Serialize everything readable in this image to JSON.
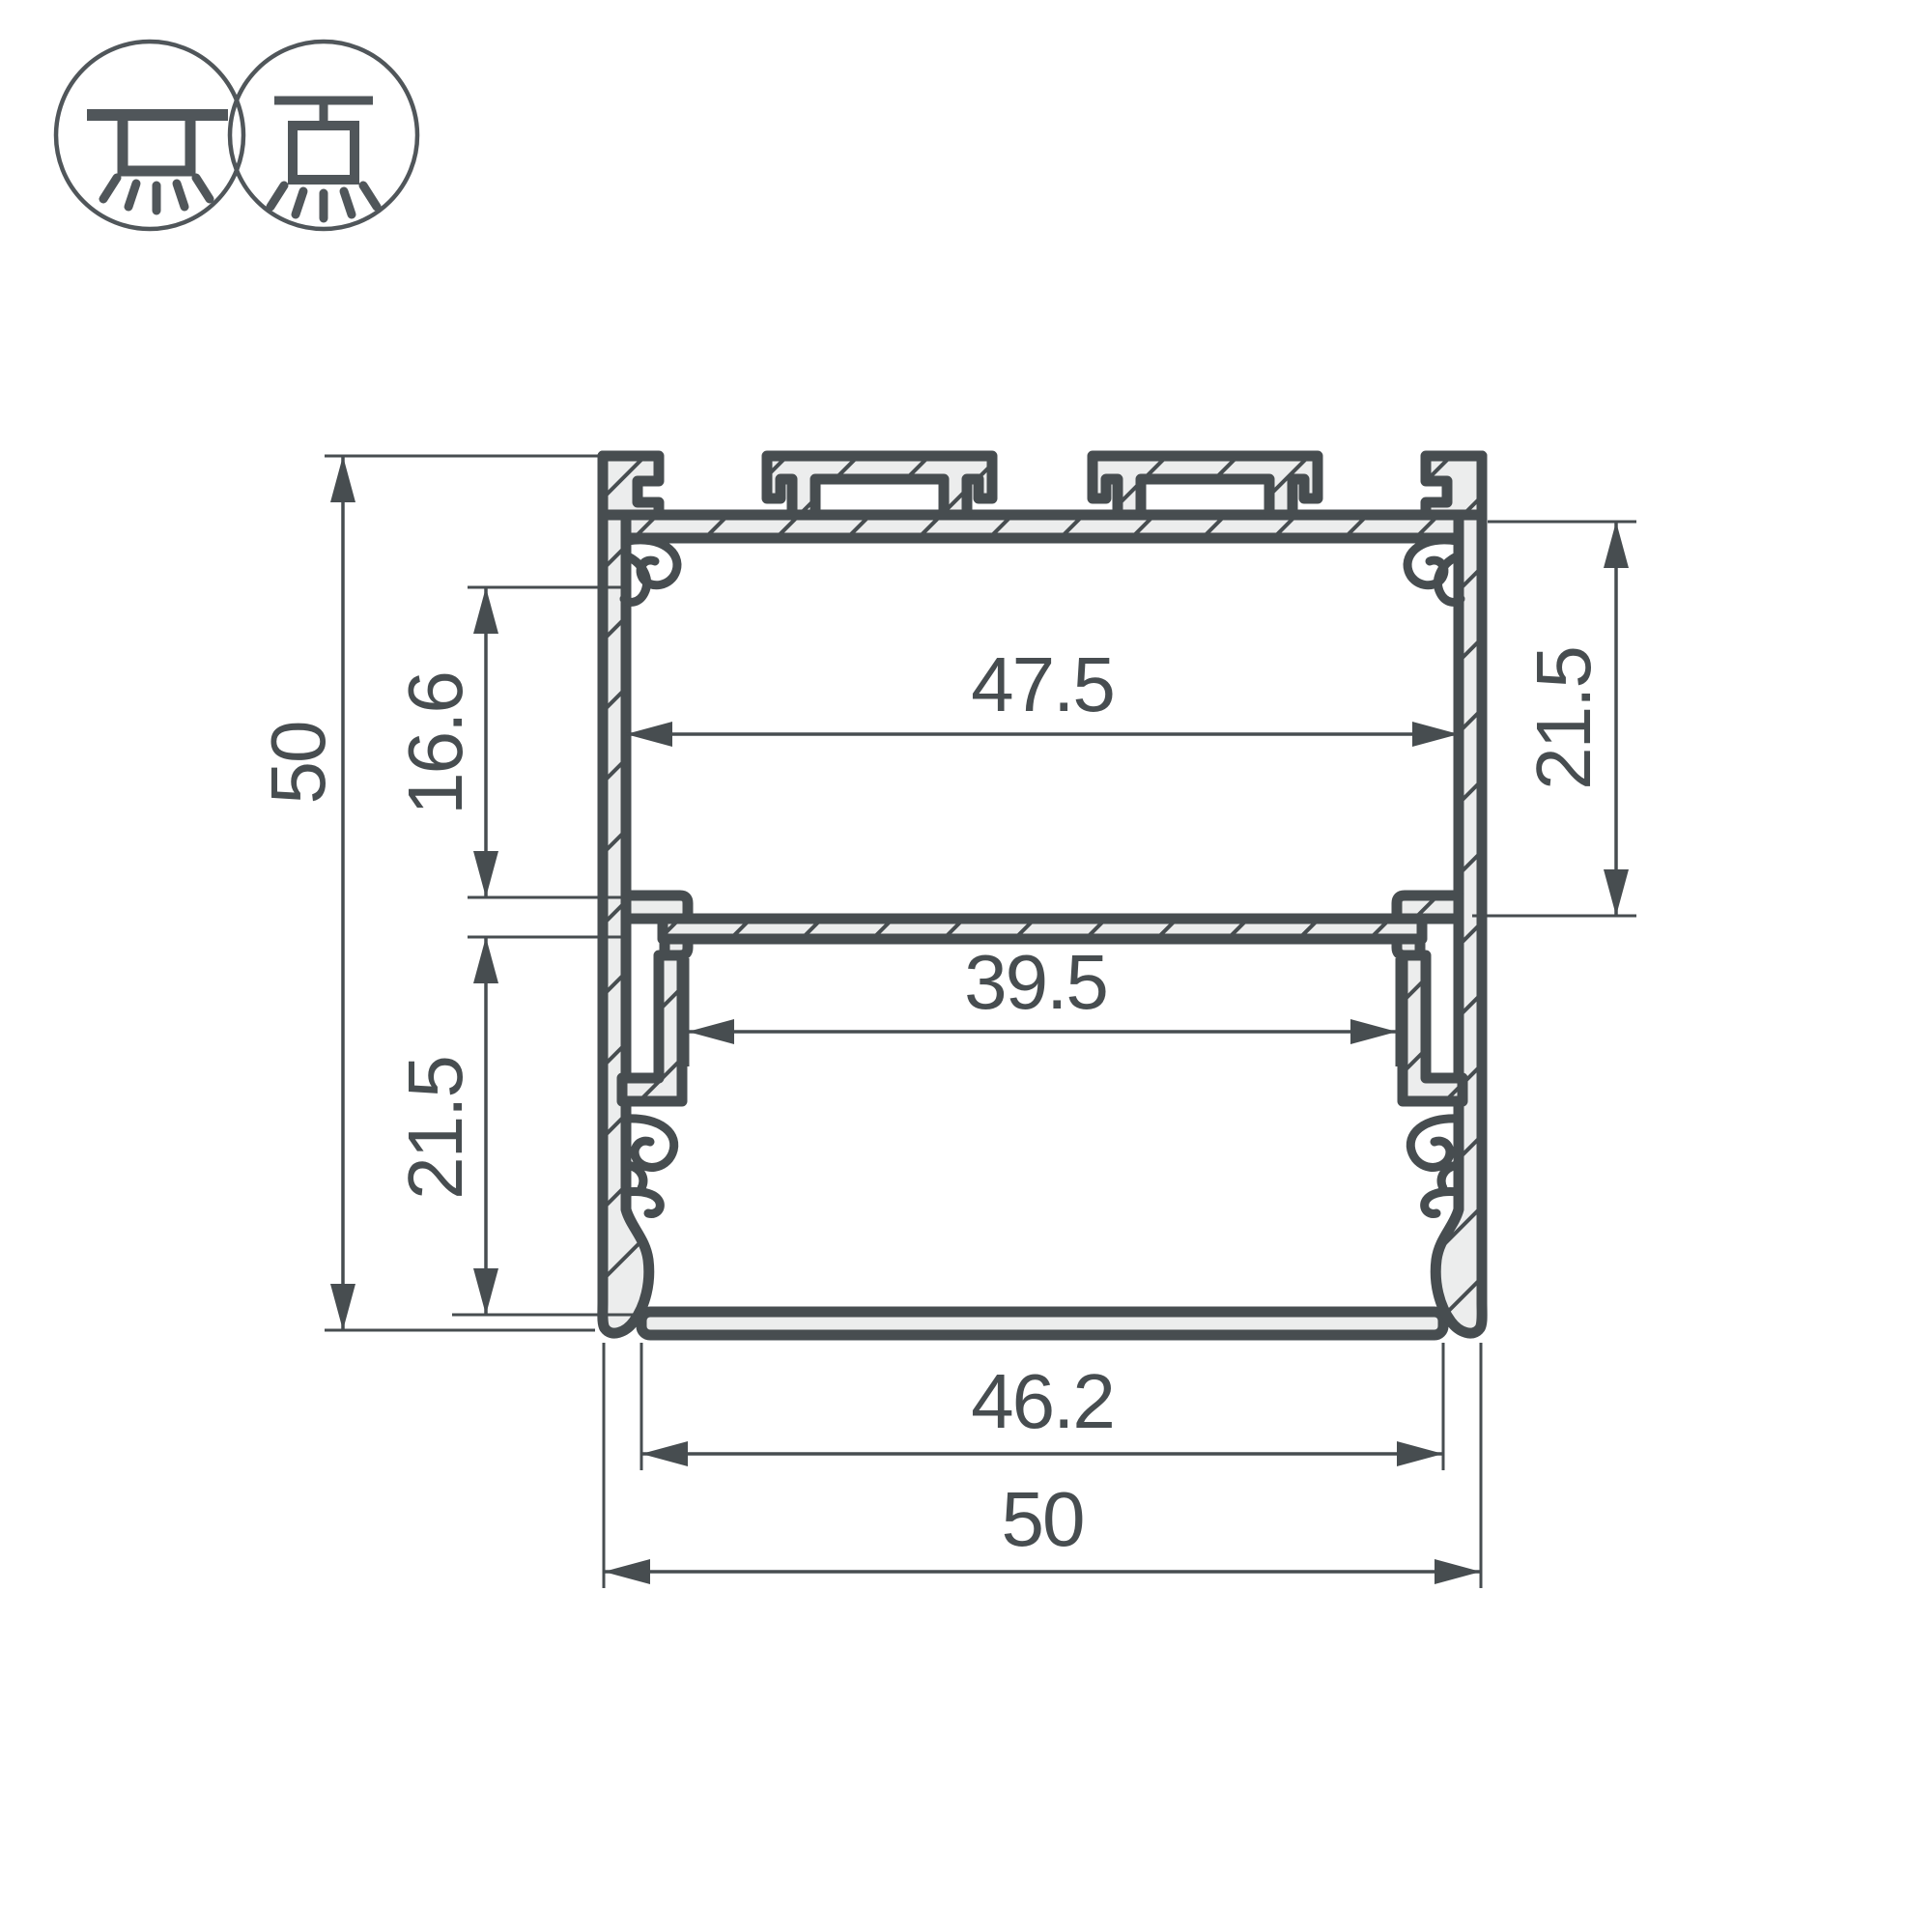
{
  "page": {
    "background": "#ffffff"
  },
  "colors": {
    "line": "#474d50",
    "metal_fill": "#eceded",
    "icon_stroke": "#50565a",
    "background": "#ffffff"
  },
  "icons": {
    "surface_mount": "surface-mount-icon",
    "pendant_mount": "pendant-mount-icon"
  },
  "drawing": {
    "type": "led-profile-cross-section",
    "dimensions": {
      "overall_height": {
        "value": "50",
        "orientation": "vertical",
        "side": "left"
      },
      "hook_to_shelf": {
        "value": "16.6",
        "orientation": "vertical",
        "side": "left"
      },
      "shelf_to_seat_left": {
        "value": "21.5",
        "orientation": "vertical",
        "side": "left"
      },
      "top_inner_width": {
        "value": "47.5",
        "orientation": "horizontal",
        "side": "top-chamber"
      },
      "top_to_shelf_right": {
        "value": "21.5",
        "orientation": "vertical",
        "side": "right"
      },
      "shelf_slot_width": {
        "value": "39.5",
        "orientation": "horizontal",
        "side": "middle"
      },
      "bottom_opening_width": {
        "value": "46.2",
        "orientation": "horizontal",
        "side": "bottom"
      },
      "overall_width": {
        "value": "50",
        "orientation": "horizontal",
        "side": "bottom"
      }
    }
  }
}
